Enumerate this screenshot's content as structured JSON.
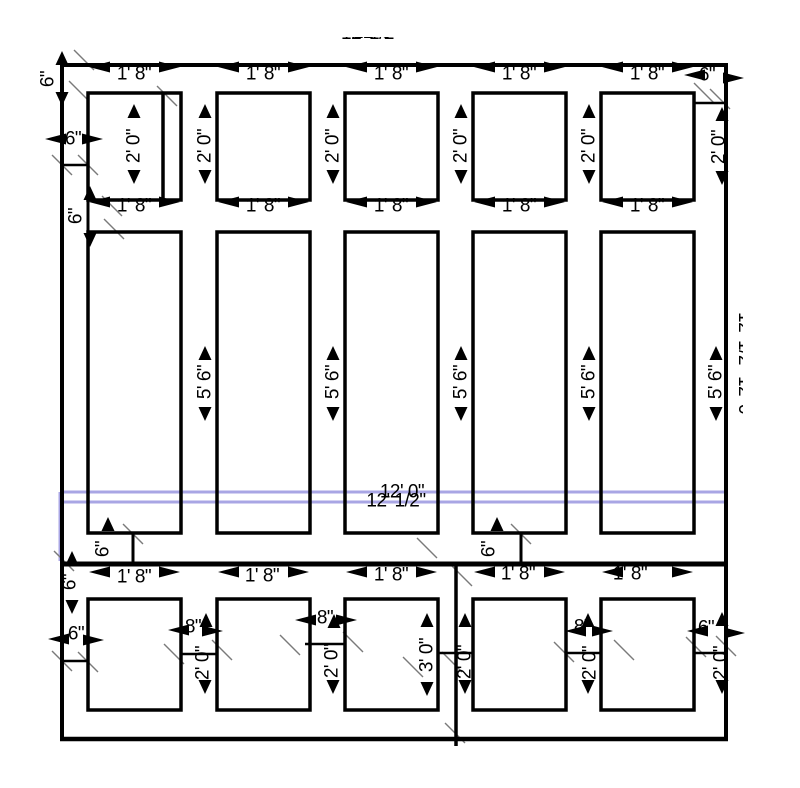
{
  "labels": {
    "ft1in8": "1' 8\"",
    "ft2in0": "2' 0\"",
    "ft5in6": "5' 6\"",
    "ft3in0": "3' 0\"",
    "in6": "6\"",
    "in8": "8\"",
    "ft12in0": "12' 0\"",
    "ft12half": "12' 1/2\""
  },
  "colors": {
    "line": "#000000",
    "tick": "#7a7a7a",
    "highlight": "#a9a6e4",
    "background": "#ffffff"
  },
  "drawing": {
    "width": 800,
    "height": 783,
    "boxes": [
      [
        88,
        93,
        93,
        107
      ],
      [
        217,
        93,
        93,
        107
      ],
      [
        345,
        93,
        93,
        107
      ],
      [
        473,
        93,
        93,
        107
      ],
      [
        601,
        93,
        93,
        107
      ],
      [
        88,
        232,
        93,
        301
      ],
      [
        217,
        232,
        93,
        301
      ],
      [
        345,
        232,
        93,
        301
      ],
      [
        473,
        232,
        93,
        301
      ],
      [
        601,
        232,
        93,
        301
      ],
      [
        88,
        599,
        93,
        111
      ],
      [
        217,
        599,
        93,
        111
      ],
      [
        345,
        599,
        93,
        111
      ],
      [
        473,
        599,
        93,
        111
      ],
      [
        601,
        599,
        93,
        111
      ]
    ],
    "lines": [
      [
        60,
        65,
        728,
        65,
        4
      ],
      [
        62,
        63,
        62,
        741,
        4
      ],
      [
        726,
        63,
        726,
        741,
        4
      ],
      [
        60,
        739,
        728,
        739,
        4.5
      ],
      [
        60,
        564,
        728,
        564,
        5
      ],
      [
        456,
        566,
        456,
        746,
        3.5
      ],
      [
        163,
        93,
        163,
        200,
        3.5
      ],
      [
        62,
        165,
        88,
        165,
        2.5
      ],
      [
        694,
        103,
        726,
        103,
        2.5
      ],
      [
        88,
        200,
        88,
        232,
        3
      ],
      [
        133,
        533,
        133,
        564,
        3
      ],
      [
        521,
        533,
        521,
        564,
        3
      ],
      [
        62,
        661,
        88,
        661,
        2.5
      ],
      [
        180,
        654,
        217,
        654,
        2.5
      ],
      [
        305,
        644,
        345,
        644,
        2.5
      ],
      [
        437,
        653,
        474,
        653,
        2.5
      ],
      [
        566,
        653,
        601,
        653,
        2.5
      ],
      [
        694,
        653,
        726,
        653,
        2.5
      ]
    ],
    "blue": [
      [
        60,
        492,
        724,
        492
      ],
      [
        60,
        502,
        726,
        502
      ],
      [
        60,
        492,
        60,
        561
      ],
      [
        726,
        502,
        726,
        561
      ]
    ],
    "ticks": [
      [
        84,
        60
      ],
      [
        79,
        91
      ],
      [
        62,
        165
      ],
      [
        88,
        165
      ],
      [
        167,
        96
      ],
      [
        112,
        206
      ],
      [
        114,
        229
      ],
      [
        704,
        93
      ],
      [
        720,
        99
      ],
      [
        133,
        534
      ],
      [
        64,
        561
      ],
      [
        427,
        548
      ],
      [
        521,
        534
      ],
      [
        462,
        576
      ],
      [
        455,
        733
      ],
      [
        62,
        661
      ],
      [
        88,
        662
      ],
      [
        174,
        654
      ],
      [
        222,
        650
      ],
      [
        290,
        645
      ],
      [
        353,
        642
      ],
      [
        564,
        652
      ],
      [
        624,
        650
      ],
      [
        696,
        647
      ],
      [
        726,
        646
      ],
      [
        413,
        667
      ],
      [
        452,
        662
      ]
    ],
    "arrows": [
      [
        89,
        67,
        "l"
      ],
      [
        180,
        67,
        "r"
      ],
      [
        218,
        67,
        "l"
      ],
      [
        309,
        67,
        "r"
      ],
      [
        346,
        67,
        "l"
      ],
      [
        437,
        67,
        "r"
      ],
      [
        474,
        67,
        "l"
      ],
      [
        565,
        67,
        "r"
      ],
      [
        602,
        67,
        "l"
      ],
      [
        693,
        67,
        "r"
      ],
      [
        684,
        75,
        "l"
      ],
      [
        744,
        78,
        "r"
      ],
      [
        45,
        139,
        "l"
      ],
      [
        103,
        139,
        "r"
      ],
      [
        89,
        202,
        "l"
      ],
      [
        180,
        202,
        "r"
      ],
      [
        218,
        202,
        "l"
      ],
      [
        309,
        202,
        "r"
      ],
      [
        346,
        202,
        "l"
      ],
      [
        437,
        202,
        "r"
      ],
      [
        474,
        202,
        "l"
      ],
      [
        565,
        202,
        "r"
      ],
      [
        602,
        202,
        "l"
      ],
      [
        693,
        202,
        "r"
      ],
      [
        89,
        572,
        "l"
      ],
      [
        180,
        572,
        "r"
      ],
      [
        218,
        572,
        "l"
      ],
      [
        309,
        572,
        "r"
      ],
      [
        346,
        572,
        "l"
      ],
      [
        437,
        572,
        "r"
      ],
      [
        474,
        572,
        "l"
      ],
      [
        565,
        572,
        "r"
      ],
      [
        602,
        572,
        "l"
      ],
      [
        693,
        572,
        "r"
      ],
      [
        168,
        630,
        "l"
      ],
      [
        223,
        631,
        "r"
      ],
      [
        295,
        620,
        "l"
      ],
      [
        357,
        620,
        "r"
      ],
      [
        565,
        631,
        "l"
      ],
      [
        613,
        631,
        "r"
      ],
      [
        687,
        631,
        "l"
      ],
      [
        745,
        633,
        "r"
      ],
      [
        48,
        639,
        "l"
      ],
      [
        104,
        640,
        "r"
      ],
      [
        134,
        104,
        "u"
      ],
      [
        134,
        184,
        "d"
      ],
      [
        205,
        104,
        "u"
      ],
      [
        205,
        184,
        "d"
      ],
      [
        333,
        104,
        "u"
      ],
      [
        333,
        184,
        "d"
      ],
      [
        461,
        104,
        "u"
      ],
      [
        461,
        184,
        "d"
      ],
      [
        589,
        104,
        "u"
      ],
      [
        589,
        184,
        "d"
      ],
      [
        722,
        107,
        "u"
      ],
      [
        722,
        185,
        "d"
      ],
      [
        205,
        346,
        "u"
      ],
      [
        205,
        421,
        "d"
      ],
      [
        333,
        346,
        "u"
      ],
      [
        333,
        421,
        "d"
      ],
      [
        461,
        346,
        "u"
      ],
      [
        461,
        421,
        "d"
      ],
      [
        589,
        346,
        "u"
      ],
      [
        589,
        421,
        "d"
      ],
      [
        716,
        346,
        "u"
      ],
      [
        716,
        421,
        "d"
      ],
      [
        206,
        613,
        "u"
      ],
      [
        205,
        694,
        "d"
      ],
      [
        334,
        614,
        "u"
      ],
      [
        333,
        694,
        "d"
      ],
      [
        465,
        613,
        "u"
      ],
      [
        465,
        694,
        "d"
      ],
      [
        588,
        613,
        "u"
      ],
      [
        588,
        694,
        "d"
      ],
      [
        722,
        612,
        "u"
      ],
      [
        722,
        694,
        "d"
      ],
      [
        427,
        613,
        "u"
      ],
      [
        427,
        696,
        "d"
      ],
      [
        62,
        51,
        "u"
      ],
      [
        62,
        106,
        "d"
      ],
      [
        90,
        186,
        "u"
      ],
      [
        90,
        247,
        "d"
      ],
      [
        72,
        551,
        "u"
      ],
      [
        72,
        614,
        "d"
      ],
      [
        108,
        517,
        "u"
      ],
      [
        497,
        517,
        "u"
      ]
    ],
    "texts": [
      [
        134,
        74,
        "ft1in8",
        0
      ],
      [
        263,
        74,
        "ft1in8",
        0
      ],
      [
        391,
        74,
        "ft1in8",
        0
      ],
      [
        519,
        74,
        "ft1in8",
        0
      ],
      [
        647,
        74,
        "ft1in8",
        0
      ],
      [
        707,
        75,
        "in6",
        0
      ],
      [
        73,
        139,
        "in6",
        0
      ],
      [
        134,
        206,
        "ft1in8",
        0
      ],
      [
        263,
        206,
        "ft1in8",
        0
      ],
      [
        391,
        206,
        "ft1in8",
        0
      ],
      [
        519,
        206,
        "ft1in8",
        0
      ],
      [
        647,
        206,
        "ft1in8",
        0
      ],
      [
        134,
        577,
        "ft1in8",
        0
      ],
      [
        262,
        576,
        "ft1in8",
        0
      ],
      [
        391,
        575,
        "ft1in8",
        0
      ],
      [
        518,
        574,
        "ft1in8",
        0
      ],
      [
        630,
        574,
        "ft1in8",
        0
      ],
      [
        193,
        627,
        "in8",
        0
      ],
      [
        325,
        618,
        "in8",
        0
      ],
      [
        582,
        627,
        "in8",
        0
      ],
      [
        76,
        634,
        "in6",
        0
      ],
      [
        706,
        628,
        "in6",
        0
      ],
      [
        402,
        492,
        "ft12in0",
        0
      ],
      [
        396,
        501,
        "ft12half",
        0
      ],
      [
        134,
        146,
        "ft2in0",
        1
      ],
      [
        205,
        146,
        "ft2in0",
        1
      ],
      [
        333,
        146,
        "ft2in0",
        1
      ],
      [
        461,
        146,
        "ft2in0",
        1
      ],
      [
        589,
        146,
        "ft2in0",
        1
      ],
      [
        719,
        147,
        "ft2in0",
        1
      ],
      [
        205,
        382,
        "ft5in6",
        1
      ],
      [
        333,
        382,
        "ft5in6",
        1
      ],
      [
        461,
        382,
        "ft5in6",
        1
      ],
      [
        589,
        382,
        "ft5in6",
        1
      ],
      [
        716,
        382,
        "ft5in6",
        1
      ],
      [
        203,
        663,
        "ft2in0",
        1
      ],
      [
        332,
        661,
        "ft2in0",
        1
      ],
      [
        465,
        662,
        "ft2in0",
        1
      ],
      [
        590,
        663,
        "ft2in0",
        1
      ],
      [
        721,
        663,
        "ft2in0",
        1
      ],
      [
        427,
        655,
        "ft3in0",
        1
      ],
      [
        48,
        79,
        "in6",
        1
      ],
      [
        76,
        216,
        "in6",
        1
      ],
      [
        70,
        582,
        "in6",
        1
      ],
      [
        103,
        549,
        "in6",
        1
      ],
      [
        489,
        549,
        "in6",
        1
      ]
    ]
  }
}
